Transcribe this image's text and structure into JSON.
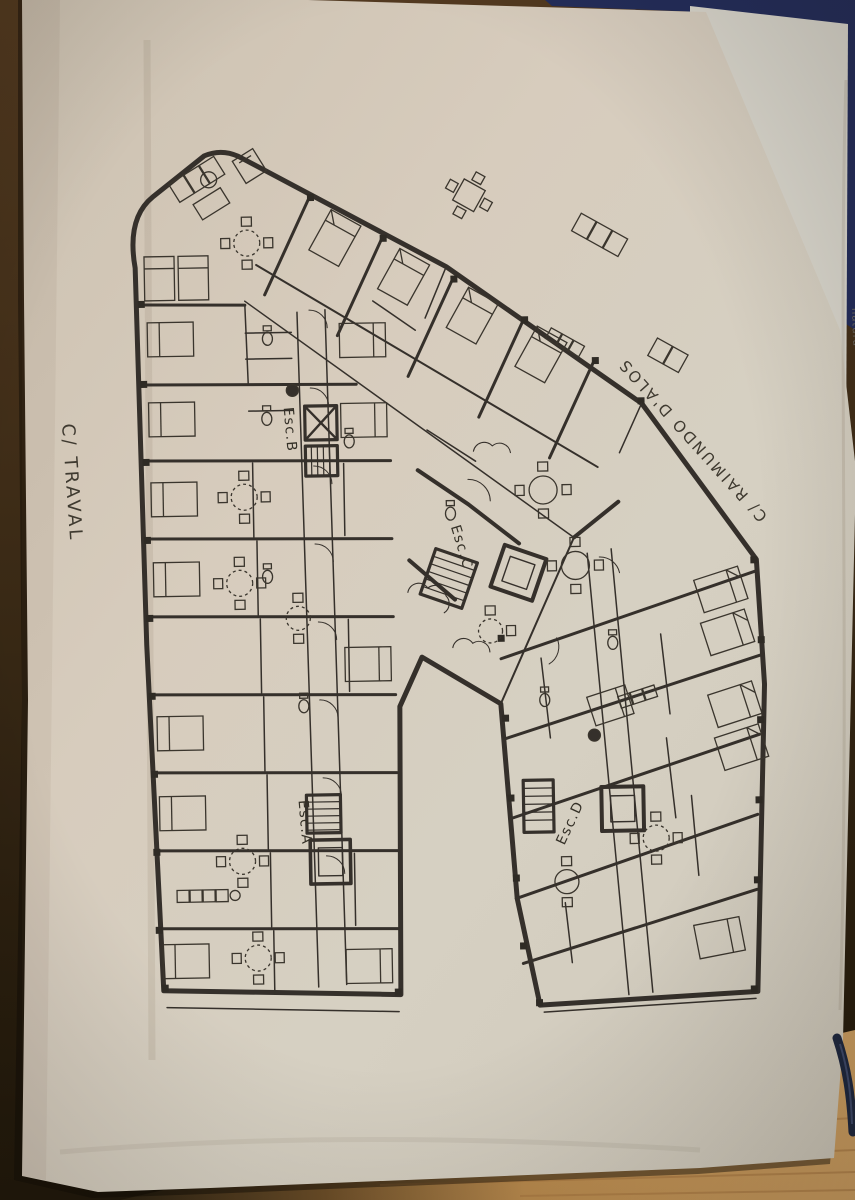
{
  "photo": {
    "colors": {
      "paper": "#d5cabb",
      "ink": "#35302a",
      "wood_dark": "#3f2c17",
      "wood_light": "#c9954f",
      "navy_folder": "#232d5e",
      "pen": "#1c2742",
      "under_sheet": "#d9d6cb"
    }
  },
  "plan_labels": {
    "street_left": "C/ TRAVAL",
    "street_right": "C/ RAIMUNDO D'ALOS",
    "stair_a": "Esc.A",
    "stair_b": "Esc.B",
    "stair_c": "Esc.C",
    "stair_d": "Esc.D"
  },
  "side_sheet": {
    "partial_text": "natura"
  }
}
